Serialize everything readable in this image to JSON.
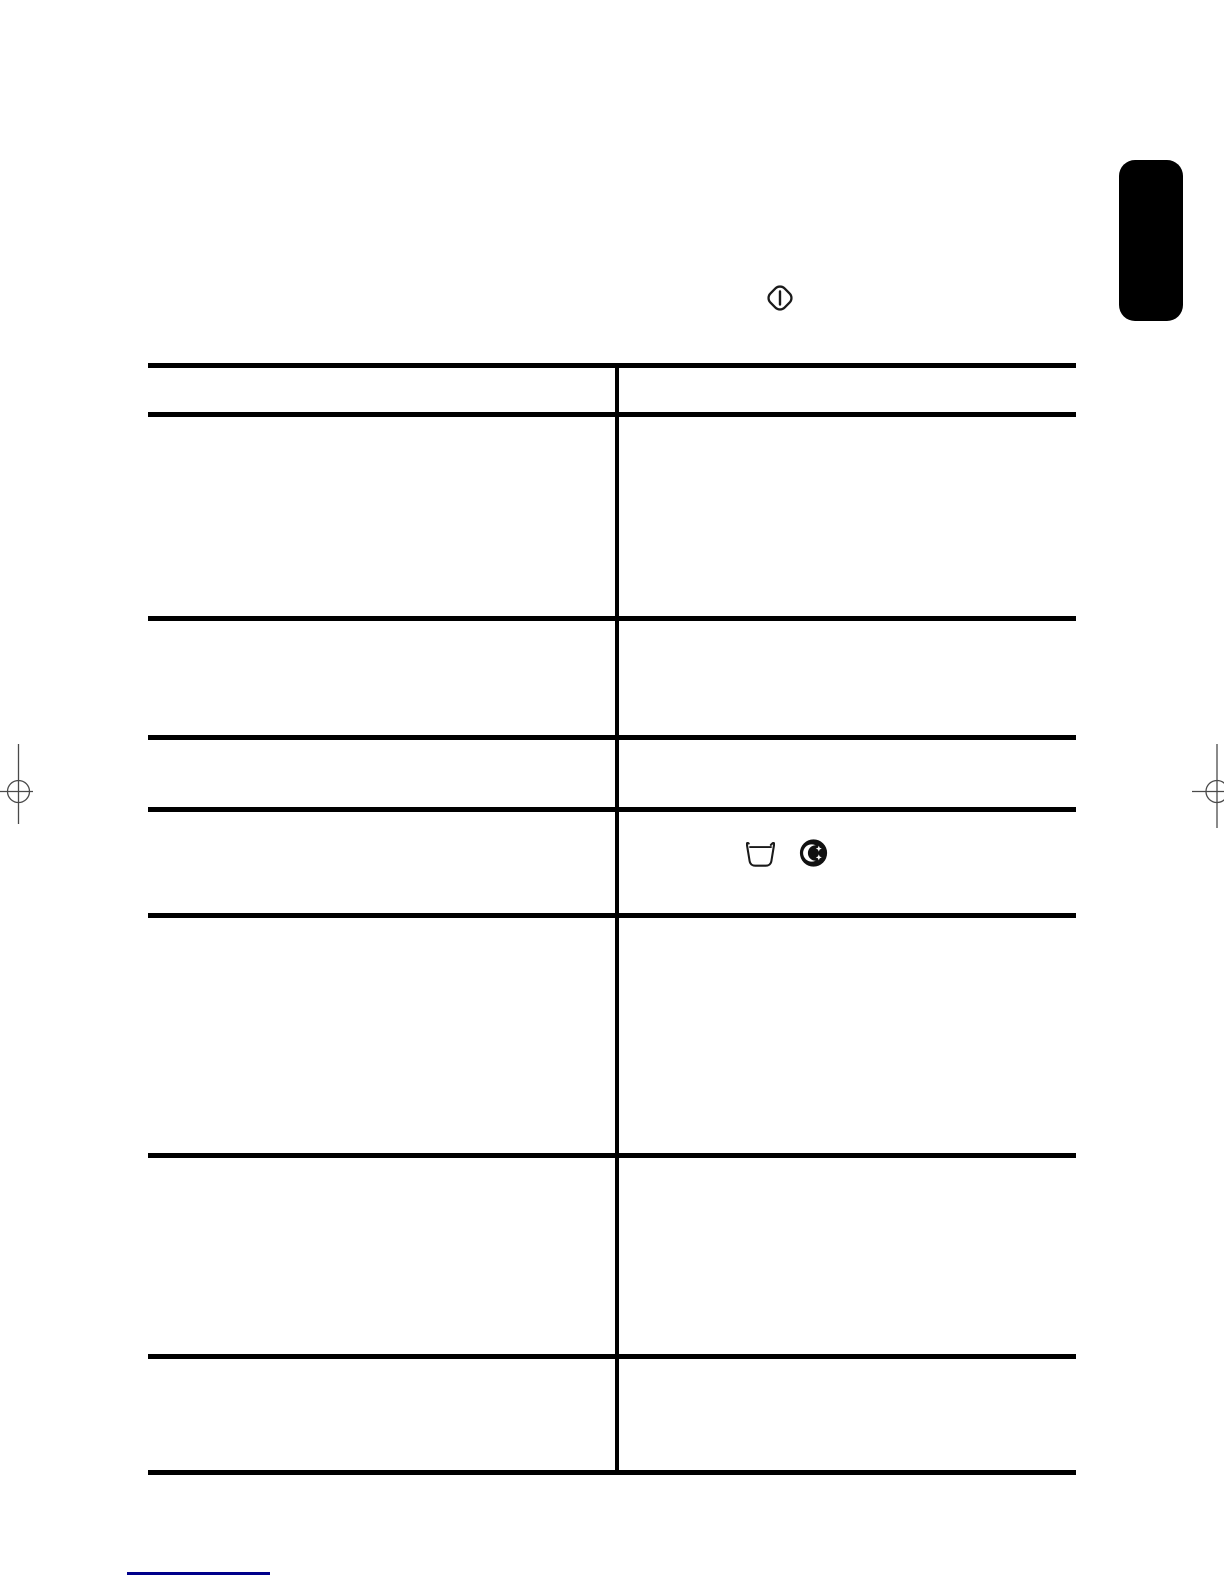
{
  "page": {
    "background_color": "#ffffff",
    "description_of_visible_content": "blank scanned manual page: ruled two-column table with no printed text, appliance symbols, black edge tab, registration marks, blue footer rule"
  },
  "colors": {
    "table_rule": "#000000",
    "section_tab": "#000000",
    "icon_stroke": "#1a1a1a",
    "registration_mark": "#4a4a4a",
    "footer_rule": "#00008b"
  },
  "symbols": {
    "start_button": "start-button-icon",
    "wash_tub": "wash-tub-icon",
    "night_wash": "night-wash-icon"
  },
  "table": {
    "header": {
      "left": "",
      "right": ""
    },
    "rows": [
      {
        "left": "",
        "right": ""
      },
      {
        "left": "",
        "right": ""
      },
      {
        "left": "",
        "right": ""
      },
      {
        "left": "",
        "right": "",
        "right_icons": [
          "wash-tub-icon",
          "night-wash-icon"
        ]
      },
      {
        "left": "",
        "right": ""
      },
      {
        "left": "",
        "right": ""
      },
      {
        "left": "",
        "right": ""
      }
    ]
  }
}
